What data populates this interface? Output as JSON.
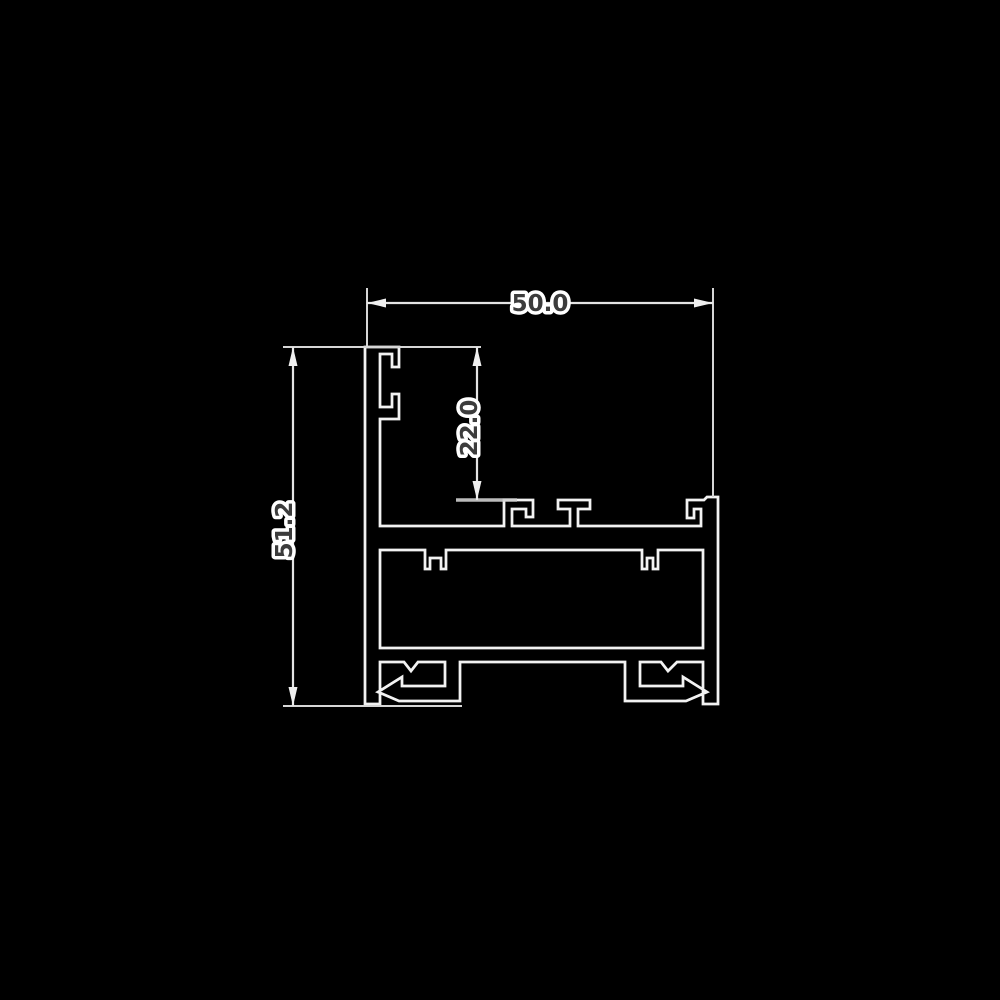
{
  "drawing": {
    "kind": "aluminium-profile-cross-section",
    "dimensions": {
      "width": {
        "value": "50.0"
      },
      "height": {
        "value": "51.2"
      },
      "channel_depth": {
        "value": "22.0"
      }
    },
    "colors": {
      "background": "#000000",
      "profile_outline": "#f2f2f2",
      "dimension_line": "#e4e4e4",
      "extension_line": "#d6d6d6",
      "arrow": "#efefef",
      "label_text": "#3c3c3c",
      "label_halo": "#ffffff"
    }
  }
}
